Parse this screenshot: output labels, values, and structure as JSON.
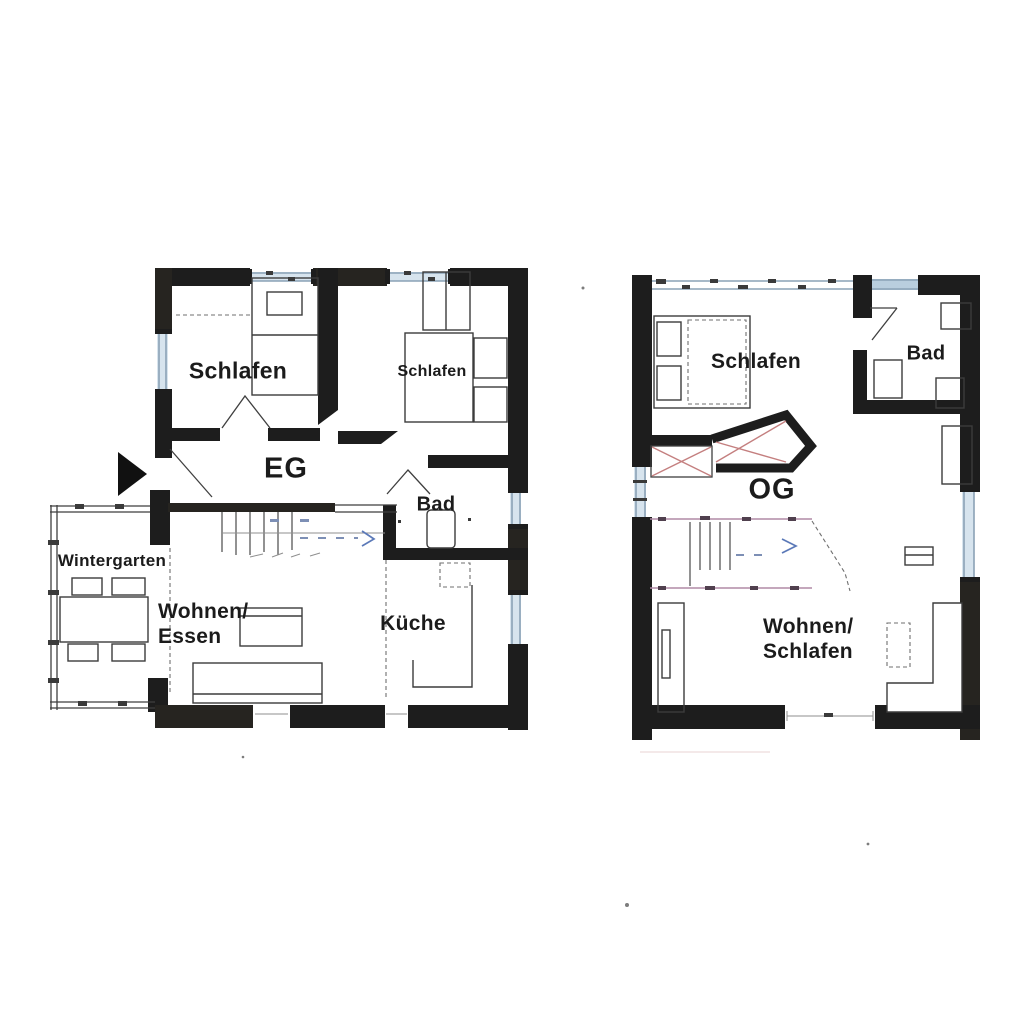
{
  "document": {
    "kind": "scanned floor plan drawing",
    "background": "#ffffff"
  },
  "floors": [
    {
      "code": "EG",
      "rooms": [
        {
          "label": "Schlafen"
        },
        {
          "label": "Schlafen"
        },
        {
          "label": "Bad"
        },
        {
          "label": "Wintergarten"
        },
        {
          "label": "Wohnen/",
          "label2": "Essen"
        },
        {
          "label": "Küche"
        }
      ]
    },
    {
      "code": "OG",
      "rooms": [
        {
          "label": "Schlafen"
        },
        {
          "label": "Bad"
        },
        {
          "label": "Wohnen/",
          "label2": "Schlafen"
        }
      ]
    }
  ],
  "icons": {
    "entrance_arrow": "solid black triangle pointing right (entry marker)",
    "stair_direction_arrow": "blue chevron arrow on staircase"
  },
  "colors": {
    "wall": "#1d1d1d",
    "window": "#8aa2b6",
    "window_fill": "#d7e4ee",
    "stair_arrow": "#5b79b8",
    "stair_edge": "#b08aa6",
    "closet_x": "#c47f7f",
    "text": "#1b1b1b"
  }
}
